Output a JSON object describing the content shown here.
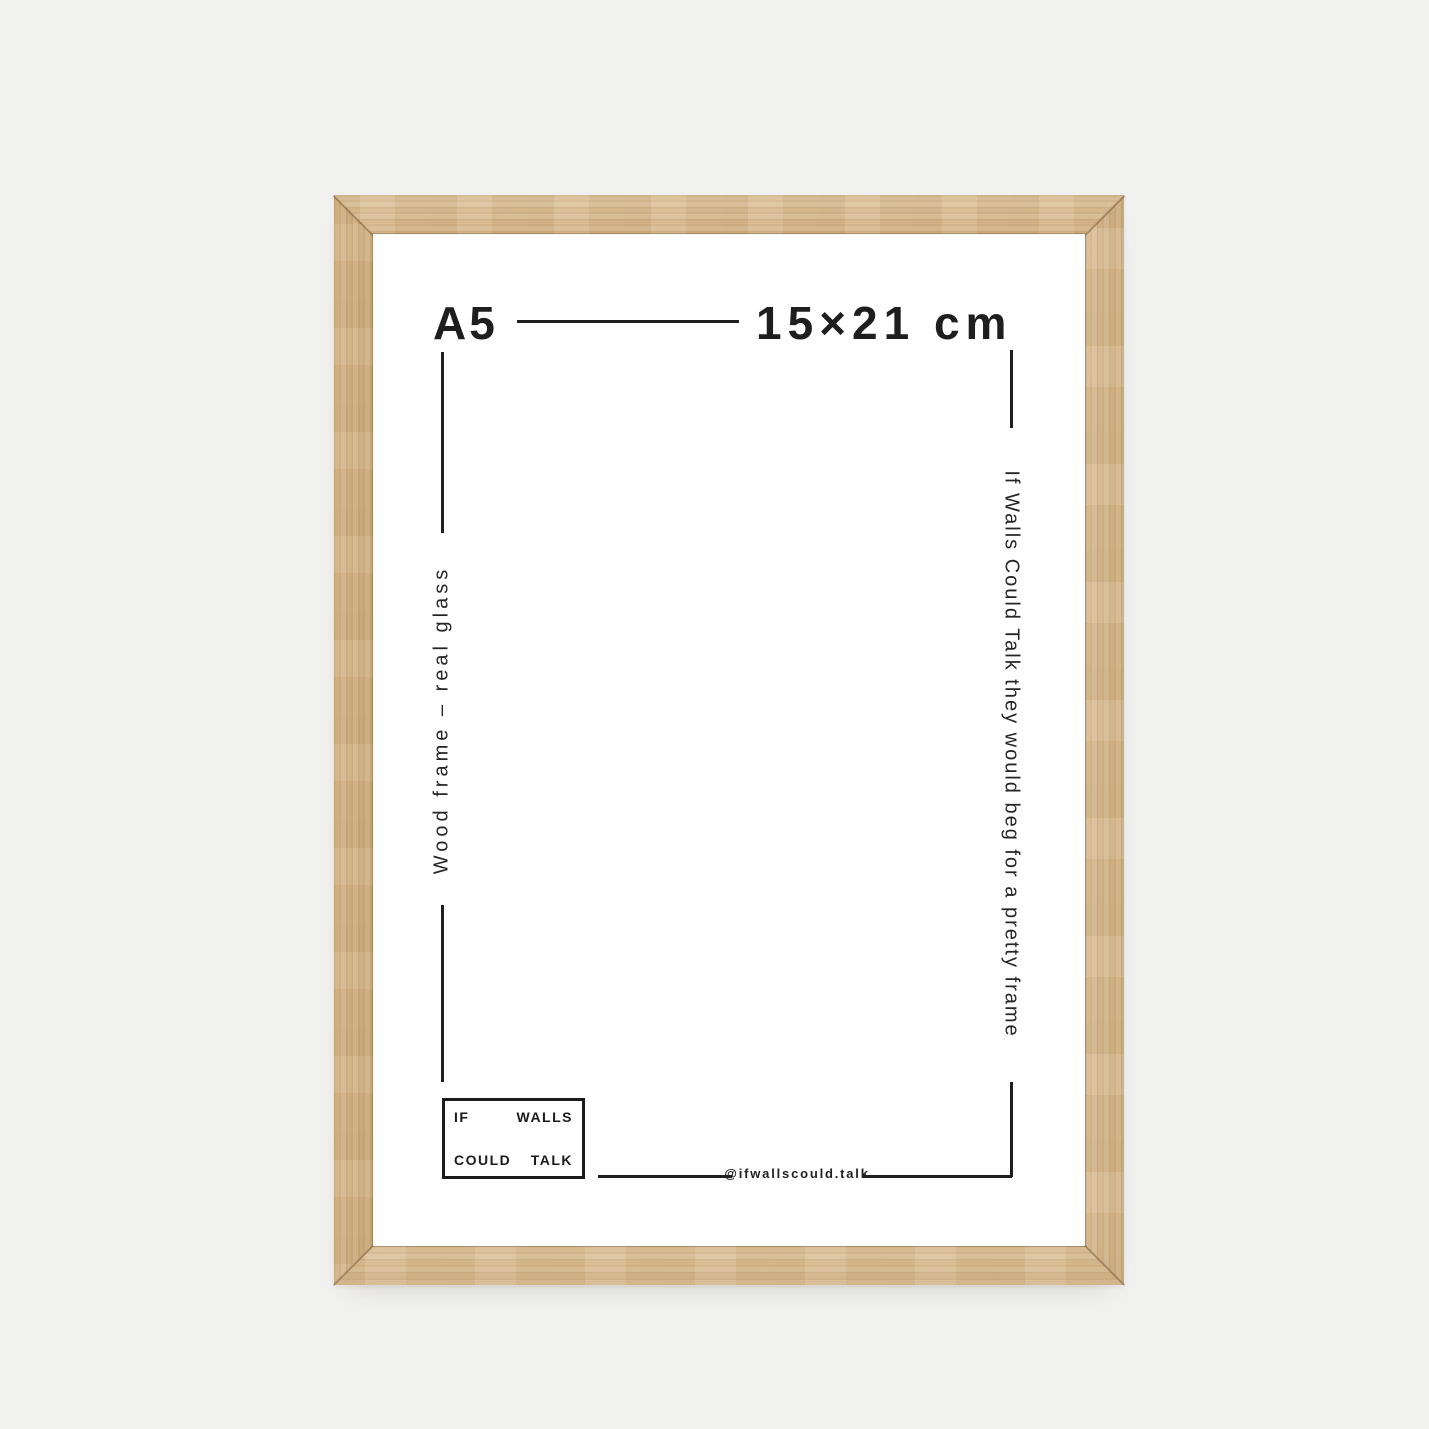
{
  "product": {
    "size_label": "A5",
    "dimensions": "15×21 cm",
    "material_note": "Wood frame – real glass",
    "tagline": "If Walls Could Talk they would beg for a pretty frame",
    "logo": {
      "top_left": "IF",
      "top_right": "WALLS",
      "bottom_left": "COULD",
      "bottom_right": "TALK"
    },
    "social_handle": "@ifwallscould.talk"
  },
  "colors": {
    "background": "#f1f1ef",
    "paper": "#fefefe",
    "ink": "#1e1e1e",
    "wood_light": "#dcc199",
    "wood_dark": "#cbaa7a"
  }
}
